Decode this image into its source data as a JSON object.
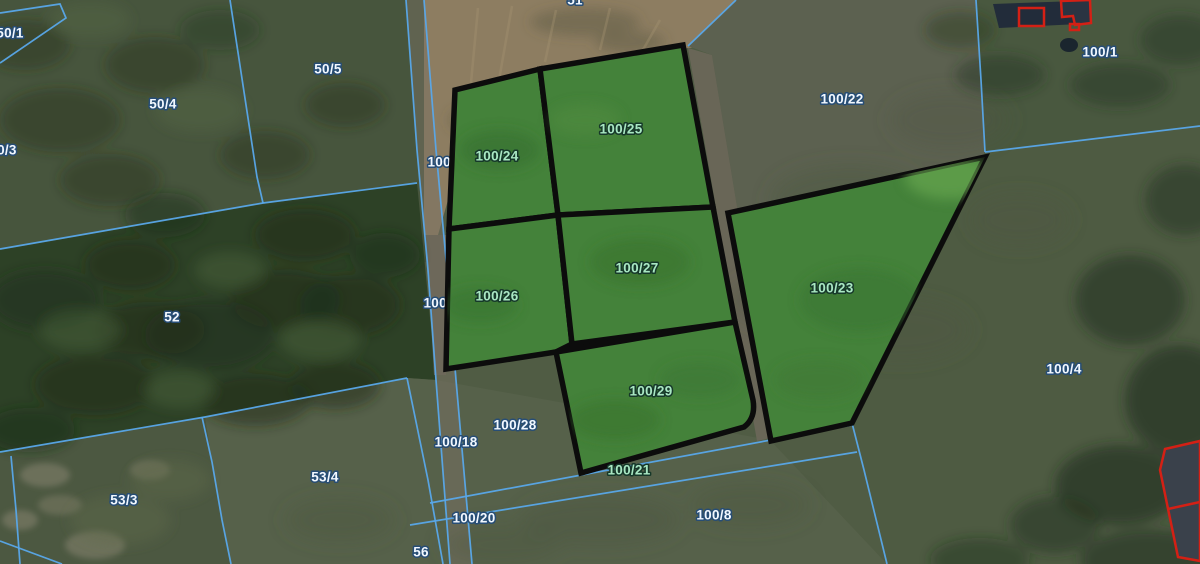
{
  "view": {
    "description": "Aerial cadastral map with parcel boundaries and highlighted parcels",
    "width_px": 1200,
    "height_px": 564
  },
  "colors": {
    "boundary_line": "#58a8ea",
    "highlight_fill": "#44823a",
    "highlight_outline": "#0c0c0c",
    "label_text": "#f2f8ff",
    "label_halo": "#274d75",
    "highlight_label_text": "#a9e7c3",
    "highlight_label_halo": "#16382a",
    "building_outline_red": "#d42015"
  },
  "highlighted_parcels": [
    {
      "id": "100-24",
      "label": "100/24",
      "x": 497,
      "y": 157
    },
    {
      "id": "100-25",
      "label": "100/25",
      "x": 621,
      "y": 130
    },
    {
      "id": "100-26",
      "label": "100/26",
      "x": 497,
      "y": 297
    },
    {
      "id": "100-27",
      "label": "100/27",
      "x": 637,
      "y": 269
    },
    {
      "id": "100-29",
      "label": "100/29",
      "x": 651,
      "y": 392
    },
    {
      "id": "100-23",
      "label": "100/23",
      "x": 832,
      "y": 289
    }
  ],
  "parcel_labels": [
    {
      "text": "51",
      "x": 575,
      "y": 1,
      "cls": "blue"
    },
    {
      "text": "50/1",
      "x": 10,
      "y": 34,
      "cls": "blue"
    },
    {
      "text": "50/4",
      "x": 163,
      "y": 105,
      "cls": "blue"
    },
    {
      "text": "50/5",
      "x": 328,
      "y": 70,
      "cls": "blue"
    },
    {
      "text": "50/3",
      "x": 3,
      "y": 151,
      "cls": "blue"
    },
    {
      "text": "52",
      "x": 172,
      "y": 318,
      "cls": "blue"
    },
    {
      "text": "100/22",
      "x": 842,
      "y": 100,
      "cls": "blue"
    },
    {
      "text": "100/1",
      "x": 1100,
      "y": 53,
      "cls": "blue"
    },
    {
      "text": "100/4",
      "x": 1064,
      "y": 370,
      "cls": "blue"
    },
    {
      "text": "100/18",
      "x": 456,
      "y": 443,
      "cls": "blue"
    },
    {
      "text": "100/28",
      "x": 515,
      "y": 426,
      "cls": "blue"
    },
    {
      "text": "100/20",
      "x": 474,
      "y": 519,
      "cls": "blue"
    },
    {
      "text": "100/21",
      "x": 629,
      "y": 471,
      "cls": "green"
    },
    {
      "text": "100/8",
      "x": 714,
      "y": 516,
      "cls": "blue"
    },
    {
      "text": "53/4",
      "x": 325,
      "y": 478,
      "cls": "blue"
    },
    {
      "text": "53/3",
      "x": 124,
      "y": 501,
      "cls": "blue"
    },
    {
      "text": "56",
      "x": 421,
      "y": 553,
      "cls": "blue"
    }
  ],
  "occluded_labels": [
    {
      "text": "100/14",
      "x": 449,
      "y": 163,
      "cls": "blue"
    },
    {
      "text": "100/16",
      "x": 445,
      "y": 304,
      "cls": "blue"
    }
  ]
}
